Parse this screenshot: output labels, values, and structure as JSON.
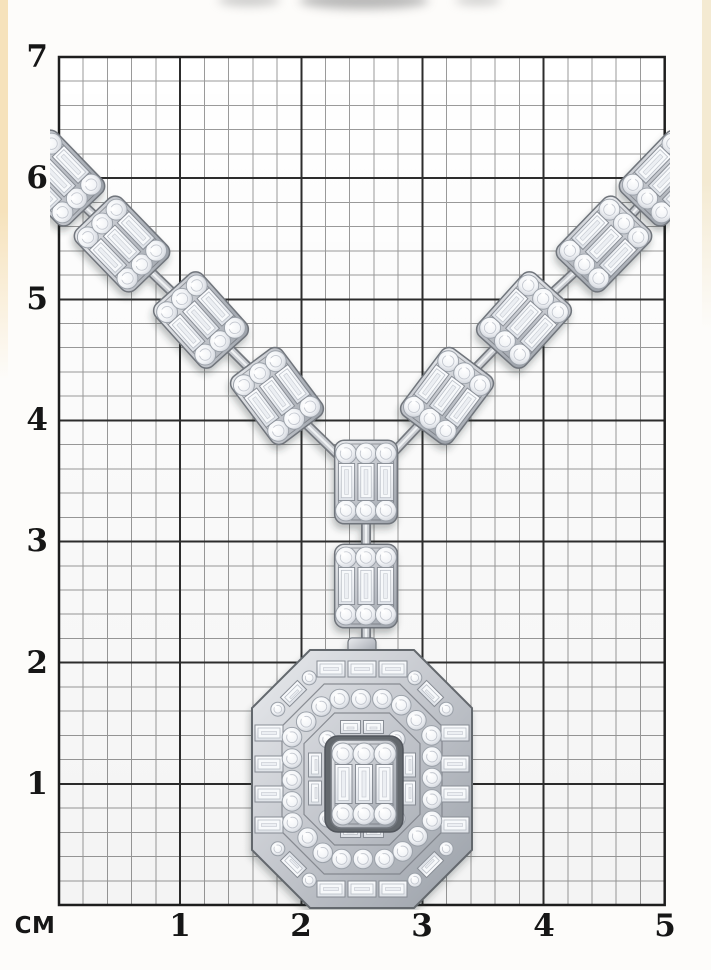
{
  "ruler": {
    "unit_label": "CM",
    "vertical": [
      "7",
      "6",
      "5",
      "4",
      "3",
      "2",
      "1"
    ],
    "horizontal": [
      "1",
      "2",
      "3",
      "4",
      "5"
    ]
  },
  "grid": {
    "left": 59,
    "top": 57,
    "cm_px": 121.14,
    "cols": 5,
    "rows": 7,
    "minor_per_cm": 5,
    "paper_color": "#ffffff",
    "minor_color": "#9a9a9a",
    "major_color": "#2d2d2d",
    "border_color": "#1e1e1e"
  },
  "edges": {
    "left_tint": "#f6e2bb",
    "right_tint": "#f4ead2"
  },
  "top_shadows": [
    {
      "x": 218,
      "w": 62,
      "h": 12,
      "o": 0.55
    },
    {
      "x": 299,
      "w": 130,
      "h": 17,
      "o": 0.75
    },
    {
      "x": 455,
      "w": 46,
      "h": 10,
      "o": 0.5
    }
  ],
  "necklace": {
    "metal_light": "#e9ebee",
    "metal_mid": "#c6c9cf",
    "metal_dark": "#9aa0a8",
    "metal_edge": "#70747b",
    "gem_fill": "#f2f4f7",
    "gem_edge": "#9ba1a9",
    "clusters": [
      {
        "cx": 57,
        "cy": 178,
        "rot": -44
      },
      {
        "cx": 122,
        "cy": 244,
        "rot": -44
      },
      {
        "cx": 201,
        "cy": 320,
        "rot": -42
      },
      {
        "cx": 277,
        "cy": 396,
        "rot": -37
      },
      {
        "cx": 667,
        "cy": 178,
        "rot": 44
      },
      {
        "cx": 604,
        "cy": 244,
        "rot": 44
      },
      {
        "cx": 524,
        "cy": 320,
        "rot": 42
      },
      {
        "cx": 447,
        "cy": 396,
        "rot": 37
      },
      {
        "cx": 366,
        "cy": 482,
        "rot": 0
      },
      {
        "cx": 366,
        "cy": 586,
        "rot": 0
      }
    ],
    "links": [
      [
        82,
        204,
        97,
        218
      ],
      [
        148,
        269,
        175,
        295
      ],
      [
        226,
        345,
        252,
        371
      ],
      [
        303,
        421,
        340,
        457
      ],
      [
        642,
        203,
        629,
        217
      ],
      [
        578,
        269,
        550,
        295
      ],
      [
        498,
        345,
        473,
        371
      ],
      [
        422,
        422,
        391,
        455
      ],
      [
        366,
        519,
        366,
        549
      ],
      [
        366,
        622,
        366,
        651
      ]
    ],
    "pendant": {
      "cx": 362,
      "cy": 779,
      "w": 220,
      "h": 258,
      "cut": 58,
      "bands": {
        "outer": {
          "ix": 17,
          "iy": 19
        },
        "rounds": {
          "ix": 40,
          "iy": 49
        },
        "inner": {
          "ix": 63,
          "iy": 77
        }
      },
      "center_cluster": {
        "cx": 364,
        "cy": 784,
        "scale": 1.0
      }
    }
  }
}
